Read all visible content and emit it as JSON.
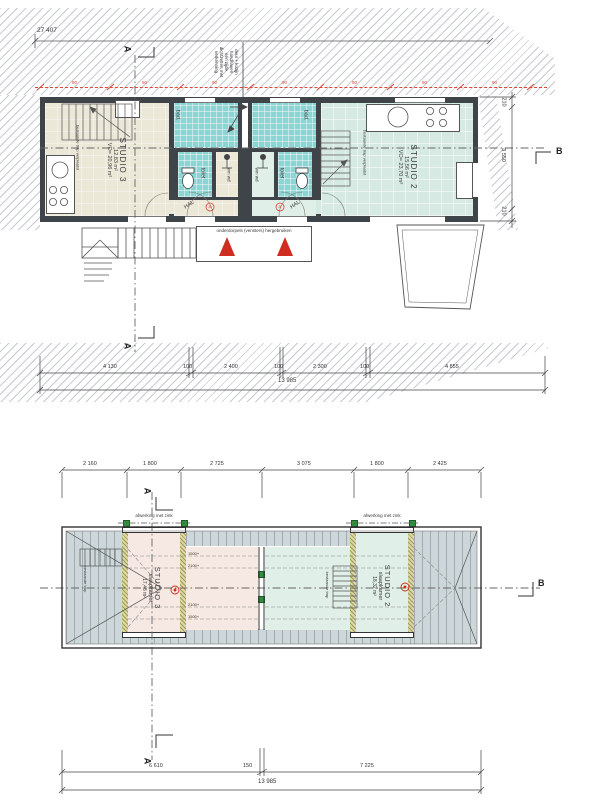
{
  "colors": {
    "bath_cyan": "#8bd6d3",
    "studio3_floor": "#ebe8d8",
    "studio2_floor": "#d6eae3",
    "attic_pink": "#f6e8e3",
    "attic_green": "#e0efe7",
    "roof_tiles": "#cdd7da",
    "dormer_wall": "#dcd8a6",
    "marker_red": "#de4437",
    "marker_green": "#2f8f3c"
  },
  "floor_plan": {
    "overall_dim": "27 407",
    "section_a": "A",
    "section_b": "B",
    "red_tick": "90",
    "wall_note": {
      "lines": [
        "deur + kozijn",
        "handhaven",
        "één zijde",
        "dichtzetten met",
        "verkenning"
      ]
    },
    "studio3": {
      "name": "STUDIO 3",
      "area": "12,83 m²",
      "vo": "VO= 20,96 m²",
      "stair_note": "bestaande trap verplaatst"
    },
    "studio2": {
      "name": "STUDIO 2",
      "area": "15,56 m²",
      "vo": "VO= 23,70 m²",
      "stair_note": "bestaande trap verplaatst"
    },
    "rooms": {
      "bad": "bad.",
      "toilet": "toilet",
      "wm_wd": "wm wd",
      "hal": "HAL",
      "door_tag": "a"
    },
    "entrance_note": "onderdorpels (vensters) hergebruiken",
    "dims_bottom": [
      "4 130",
      "100",
      "2 400",
      "100",
      "2 300",
      "100",
      "4 855"
    ],
    "total_bottom": "13 985",
    "dims_right": [
      "210",
      "3 550",
      "210"
    ]
  },
  "roof_plan": {
    "dims_top": [
      "2 160",
      "1 800",
      "2 725",
      "3 075",
      "1 800",
      "2 425"
    ],
    "dims_bottom": [
      "6 610",
      "150",
      "7 225"
    ],
    "total_bottom": "13 985",
    "zinc_note": "afwerking met zink",
    "studio3": {
      "name": "STUDIO 3",
      "room": "slaapkamer",
      "area": "17,48 m²",
      "stair_note": "bestaande trap"
    },
    "studio2": {
      "name": "STUDIO 2",
      "room": "slaapkamer",
      "area": "18,32 m²",
      "stair_note": "bestaande trap"
    },
    "height_marks": [
      "1500+",
      "2100+",
      "2100+",
      "1500+"
    ],
    "section_a": "A",
    "section_b": "B"
  }
}
